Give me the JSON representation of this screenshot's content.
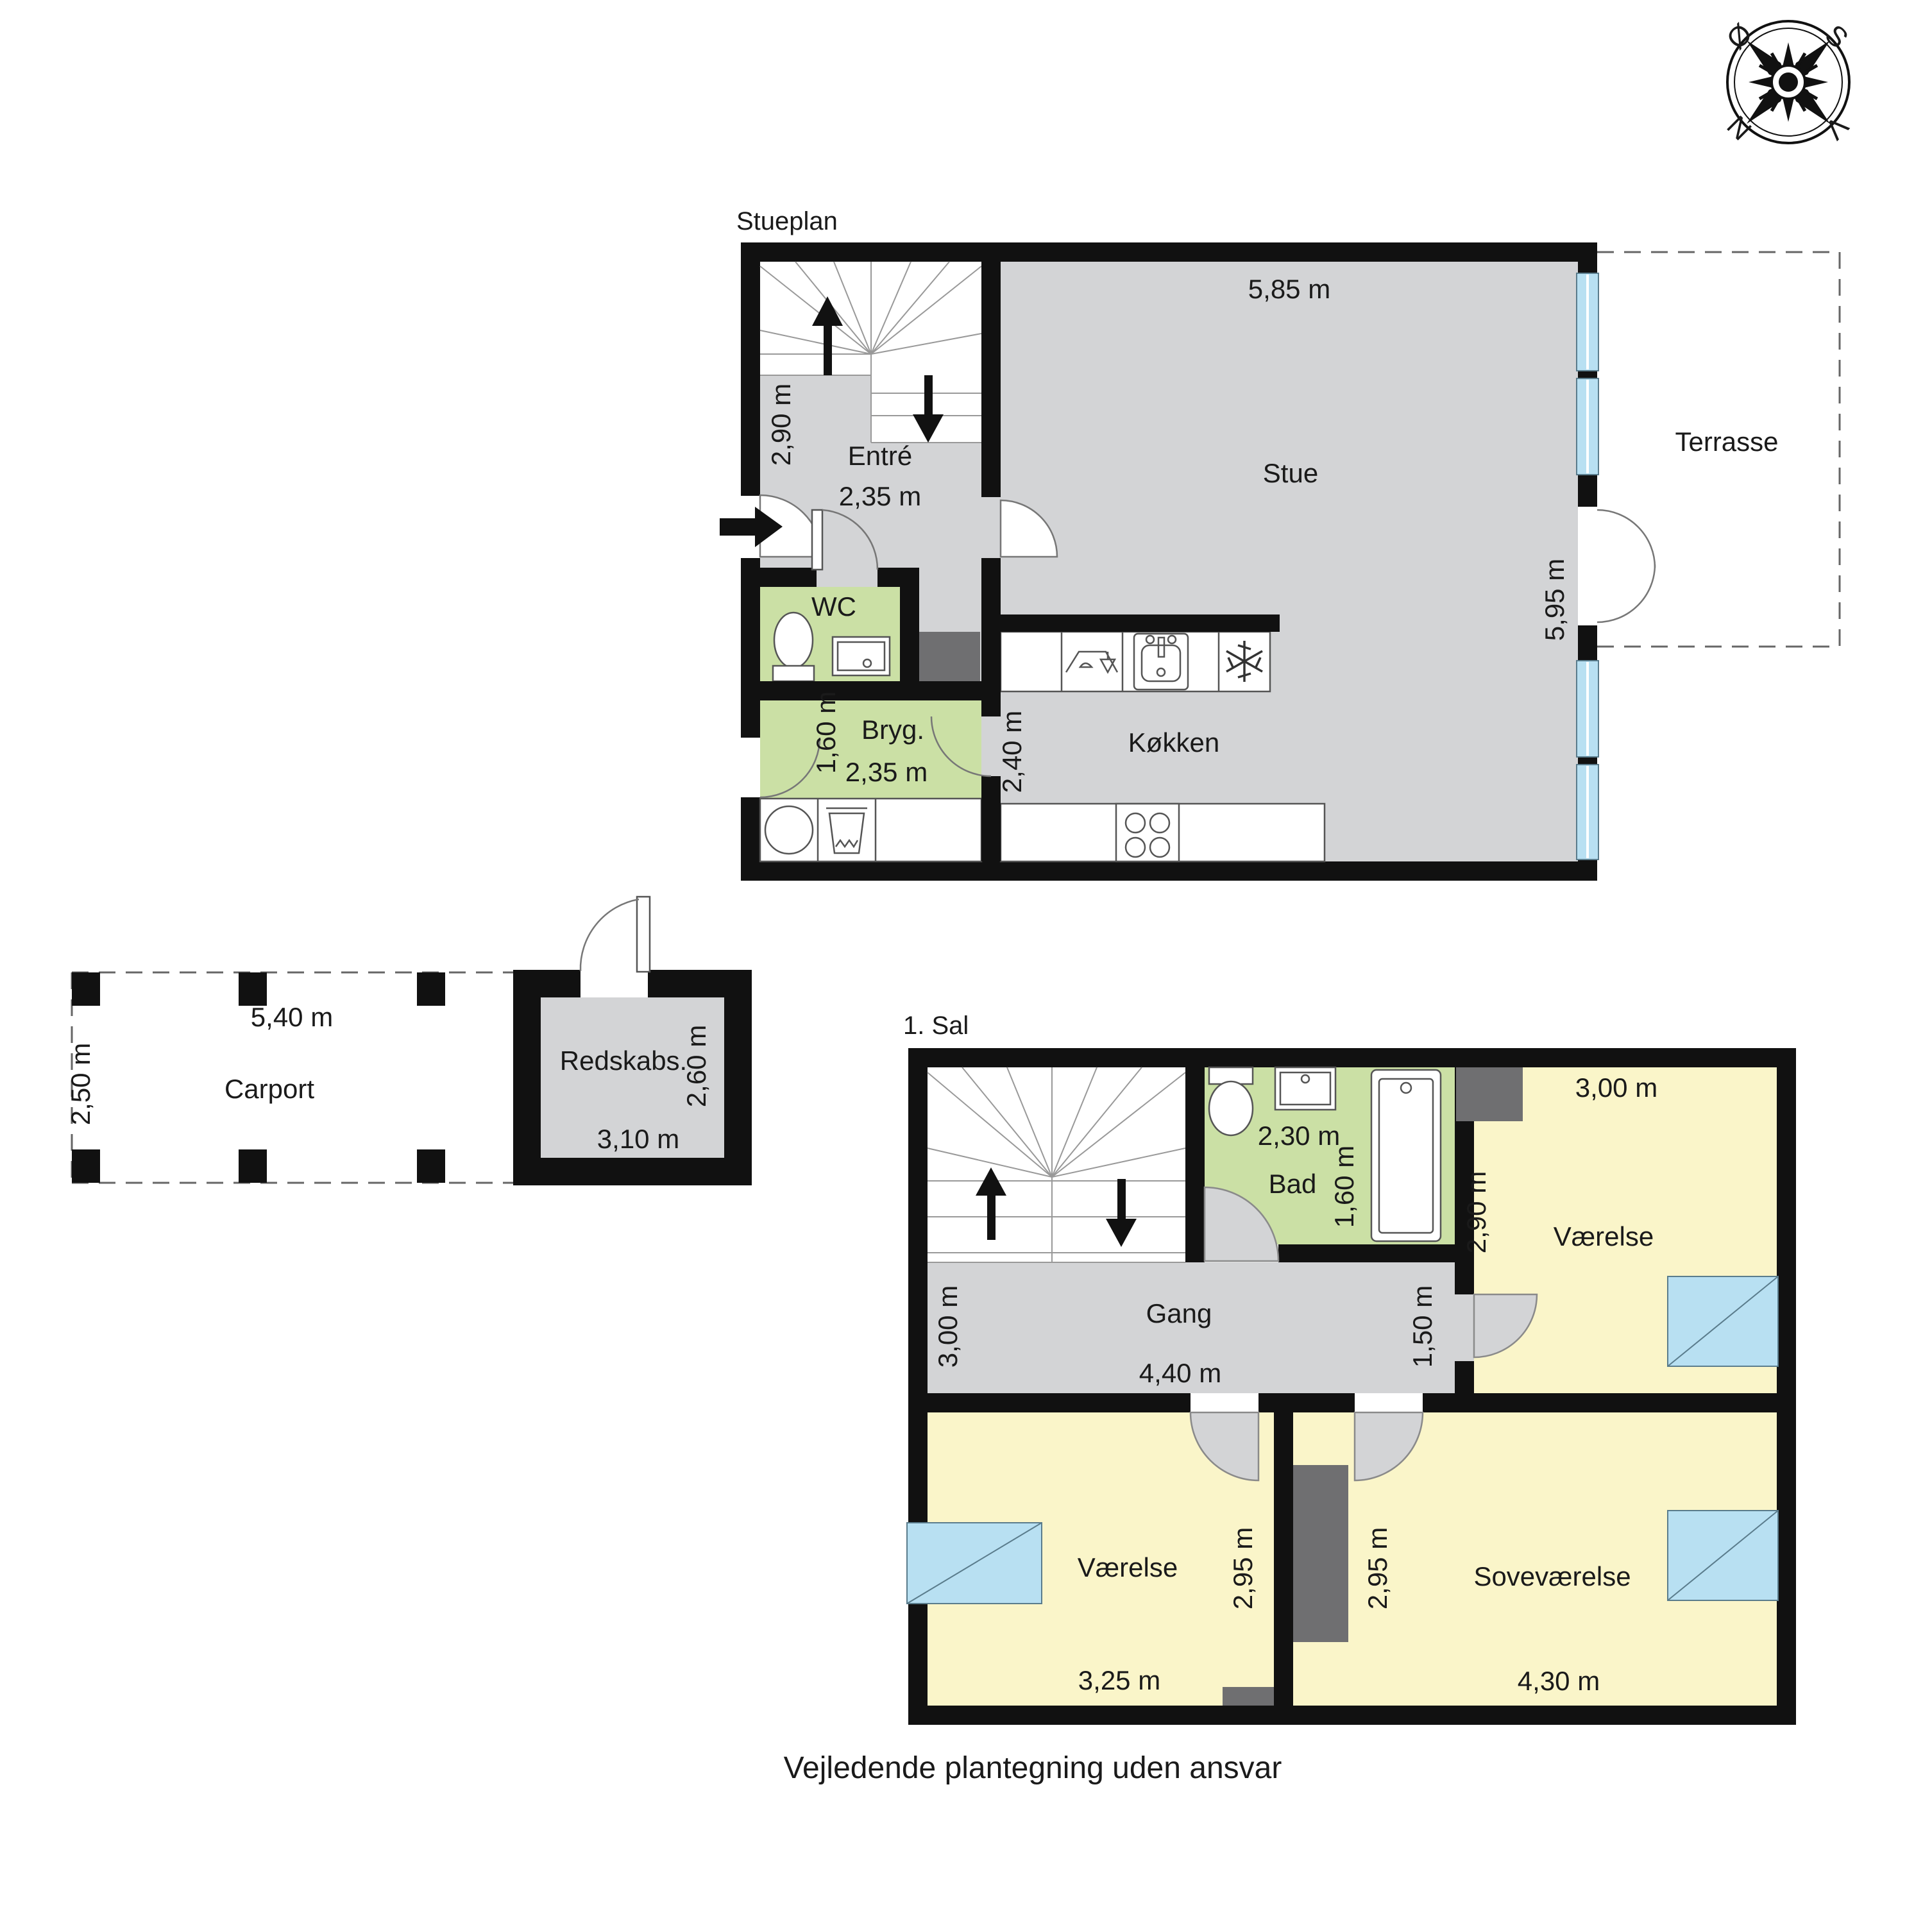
{
  "footer": "Vejledende plantegning uden ansvar",
  "compass": {
    "east": "Ø",
    "south": "S",
    "north": "N",
    "west": "V"
  },
  "stueplan": {
    "title": "Stueplan",
    "entre": {
      "label": "Entré",
      "width": "2,35 m",
      "height": "2,90 m"
    },
    "stue": {
      "label": "Stue",
      "width": "5,85 m",
      "height": "5,95 m"
    },
    "wc": {
      "label": "WC"
    },
    "bryg": {
      "label": "Bryg.",
      "width": "2,35 m",
      "height": "1,60 m"
    },
    "kokken": {
      "label": "Køkken",
      "height": "2,40 m"
    },
    "terrasse": {
      "label": "Terrasse"
    }
  },
  "sal1": {
    "title": "1. Sal",
    "bad": {
      "label": "Bad",
      "width": "2,30 m",
      "height": "1,60 m"
    },
    "gang": {
      "label": "Gang",
      "width": "4,40 m",
      "height": "3,00 m",
      "corridor": "1,50 m"
    },
    "vaerelse_ne": {
      "label": "Værelse",
      "width": "3,00 m",
      "height": "2,90 m"
    },
    "vaerelse_sw": {
      "label": "Værelse",
      "width": "3,25 m",
      "height": "2,95 m"
    },
    "sovevaerelse": {
      "label": "Soveværelse",
      "width": "4,30 m",
      "height": "2,95 m"
    }
  },
  "outbuildings": {
    "carport": {
      "label": "Carport",
      "width": "5,40 m",
      "height": "2,50 m"
    },
    "redskabs": {
      "label": "Redskabs.",
      "width": "3,10 m",
      "height": "2,60 m"
    }
  }
}
